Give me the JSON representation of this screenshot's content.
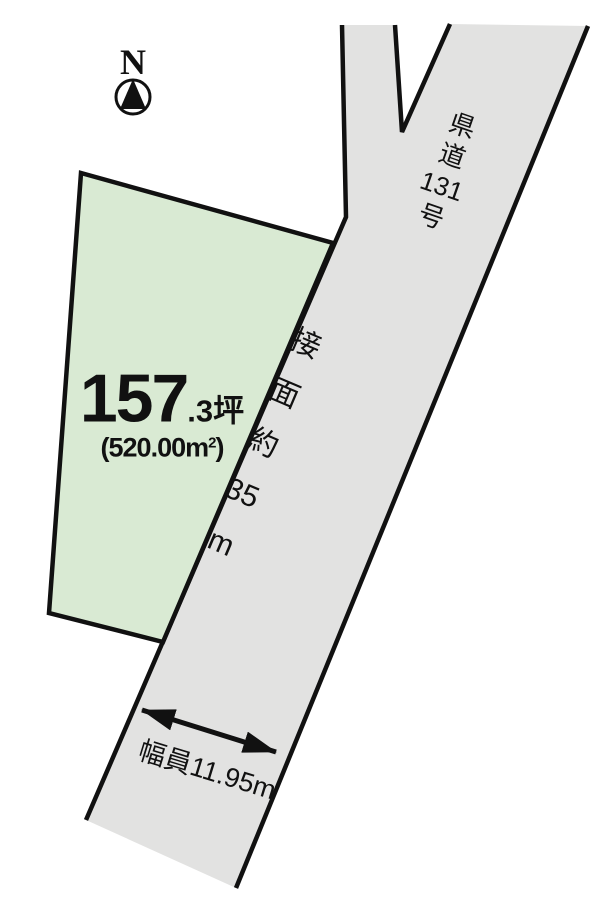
{
  "compass": {
    "north_label": "N"
  },
  "parcel": {
    "area_tsubo_int": "157",
    "area_tsubo_frac": ".3坪",
    "area_m2_prefix": "(520.00m",
    "area_m2_exponent": "2",
    "area_m2_suffix": ")"
  },
  "road": {
    "name_chars": [
      "県",
      "道",
      "131",
      "号"
    ],
    "frontage_chars": [
      "接",
      "面",
      "約",
      "35",
      "m"
    ],
    "width_label": "幅員11.95m"
  },
  "colors": {
    "parcel_fill": "#d9ead3",
    "road_fill": "#e2e2e1",
    "outline": "#111111"
  }
}
